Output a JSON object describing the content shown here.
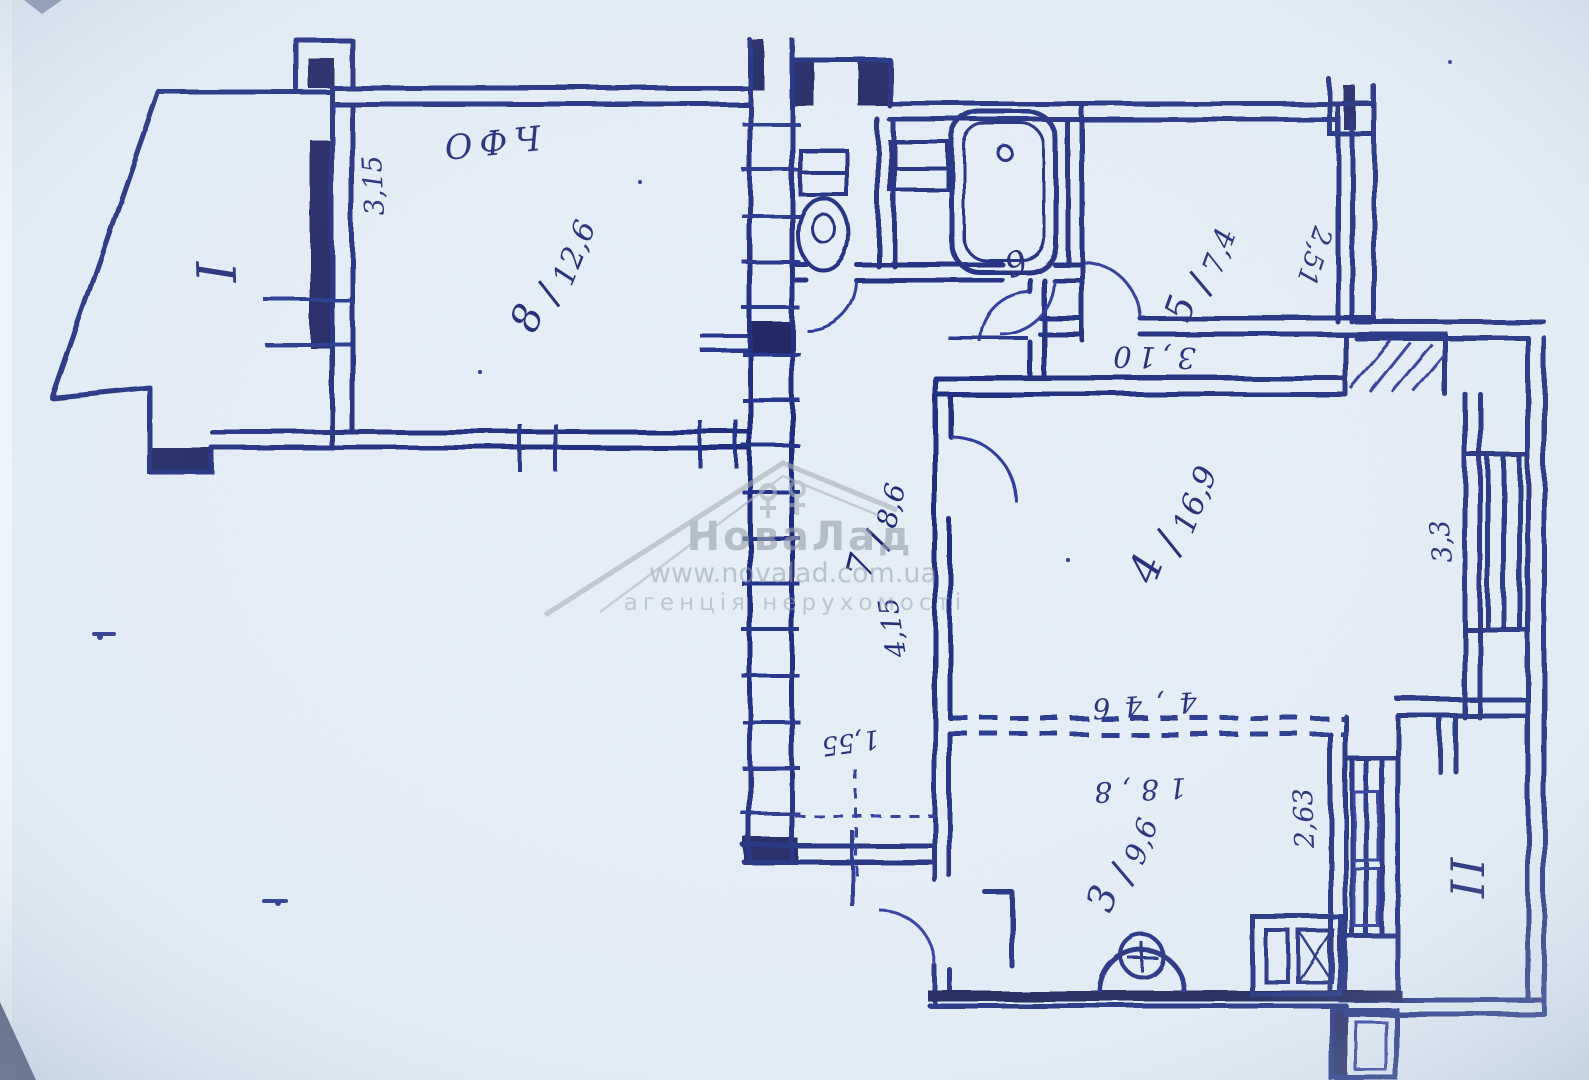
{
  "watermark": {
    "brand": "НоваЛад",
    "url": "www.novalad.com.ua",
    "tagline": "агенція нерухомості"
  },
  "plan": {
    "balconies": {
      "first": "I",
      "second": "II"
    },
    "rooms": {
      "r8": {
        "number": "8",
        "area": "12,6"
      },
      "r5": {
        "number": "5",
        "area": "7,4"
      },
      "r6": {
        "number": "6"
      },
      "r7": {
        "number": "7",
        "area": "8,6"
      },
      "r4": {
        "number": "4",
        "area": "16,9"
      },
      "r3": {
        "number": "3",
        "area": "9,6"
      }
    },
    "dimensions": {
      "room8_side": "3,15",
      "kitchen_side": "2,51",
      "kitchen_width": "3,10",
      "bedroom_window": "3,3",
      "room3_window": "2,63",
      "hall_length": "4,15",
      "hall_width": "1,55",
      "bedroom_bottom": "4,46",
      "room3_top": "18,8"
    },
    "note": "ОФЧ"
  }
}
